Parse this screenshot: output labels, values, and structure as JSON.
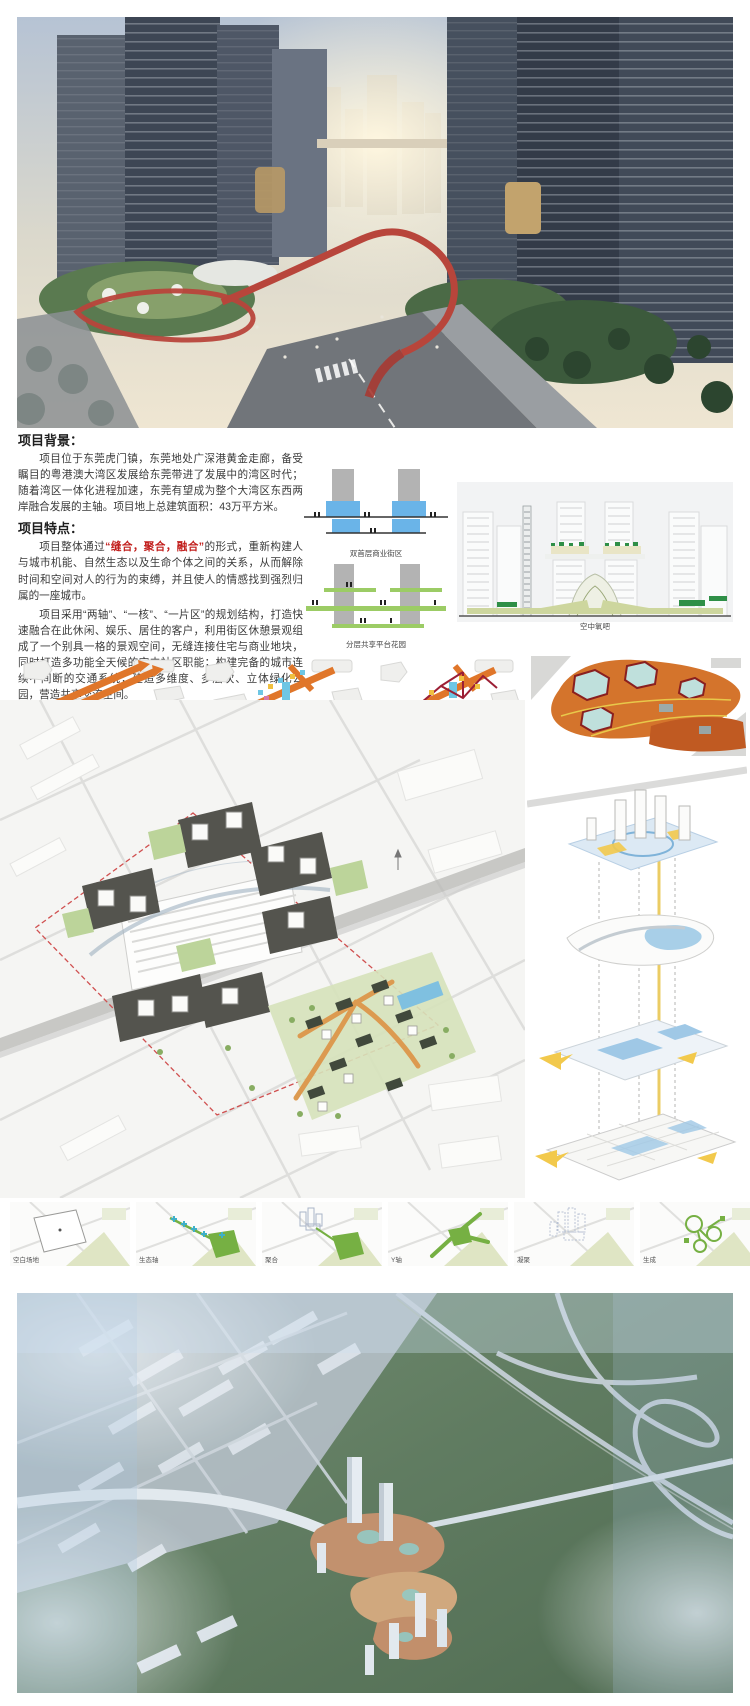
{
  "board_title": "东莞虎门镇城市设计展板",
  "colors": {
    "accent_red": "#c2201e",
    "diagram_orange": "#e0762a",
    "eco_green": "#76b043",
    "podium_blue": "#6ab4e8",
    "platform_green": "#9ccc65",
    "boundary_red_dash": "#d05050"
  },
  "background_section": {
    "heading": "项目背景：",
    "body": "项目位于东莞虎门镇，东莞地处广深港黄金走廊，备受瞩目的粤港澳大湾区发展给东莞带进了发展中的湾区时代；随着湾区一体化进程加速，东莞有望成为整个大湾区东西两岸融合发展的主轴。项目地上总建筑面积：43万平方米。"
  },
  "features_section": {
    "heading": "项目特点：",
    "p1_before": "项目整体通过",
    "p1_highlight": "“缝合，聚合，融合”",
    "p1_after": "的形式，重新构建人与城市机能、自然生态以及生命个体之间的关系，从而解除时间和空间对人的行为的束缚，并且使人的情感找到强烈归属的一座城市。",
    "p2": "项目采用“两轴”、“一核”、“一片区”的规划结构，打造快速融合在此休闲、娱乐、居住的客户，利用街区休憩景观组成了一个别具一格的景观空间，无缝连接住宅与商业地块，同时打造多功能全天候的空中社区职能；构建完备的城市连续不间断的交通系统；建造多维度、多层次、立体绿化公园，营造共享交流空间。"
  },
  "diagrams": {
    "double_ground_caption": "双首层商业街区",
    "platform_caption": "分层共享平台花园",
    "elevation_caption": "空中氧吧"
  },
  "process_row": {
    "labels": [
      "空白场地",
      "生态轴",
      "聚合",
      "Y轴",
      "凝聚",
      "生成"
    ]
  }
}
